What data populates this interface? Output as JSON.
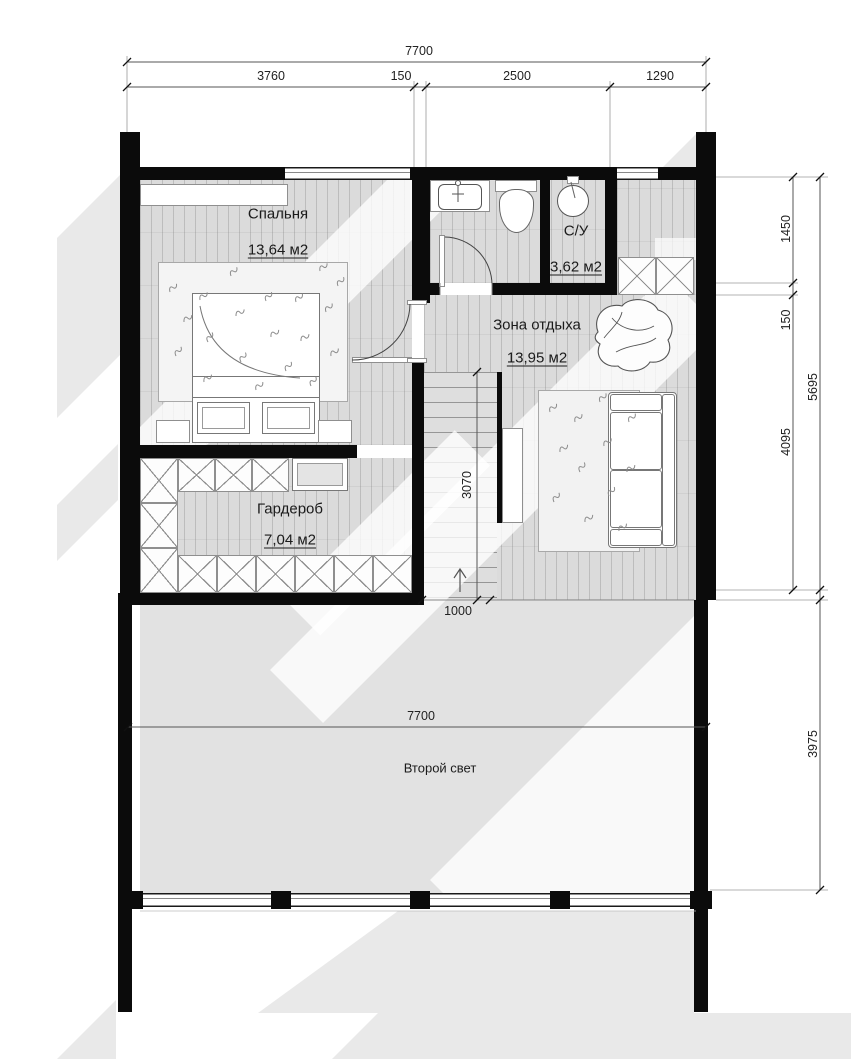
{
  "rooms": {
    "bedroom": {
      "name": "Спальня",
      "area": "13,64 м2"
    },
    "bathroom": {
      "name": "С/У",
      "area": "3,62 м2"
    },
    "lounge": {
      "name": "Зона отдыха",
      "area": "13,95 м2"
    },
    "wardrobe": {
      "name": "Гардероб",
      "area": "7,04 м2"
    },
    "second_light": {
      "name": "Второй свет"
    }
  },
  "dimensions": {
    "top_total": "7700",
    "top_segments": [
      "3760",
      "150",
      "2500",
      "1290"
    ],
    "right_segments": [
      "1450",
      "150",
      "4095"
    ],
    "right_total": "5695",
    "right_lower": "3975",
    "stair_run": "3070",
    "stair_width": "1000",
    "bottom_width": "7700"
  },
  "colors": {
    "wall": "#0b0b0b",
    "wood_floor": "#dbdbdb",
    "void_floor": "#e2e2e2",
    "line": "#333333"
  }
}
